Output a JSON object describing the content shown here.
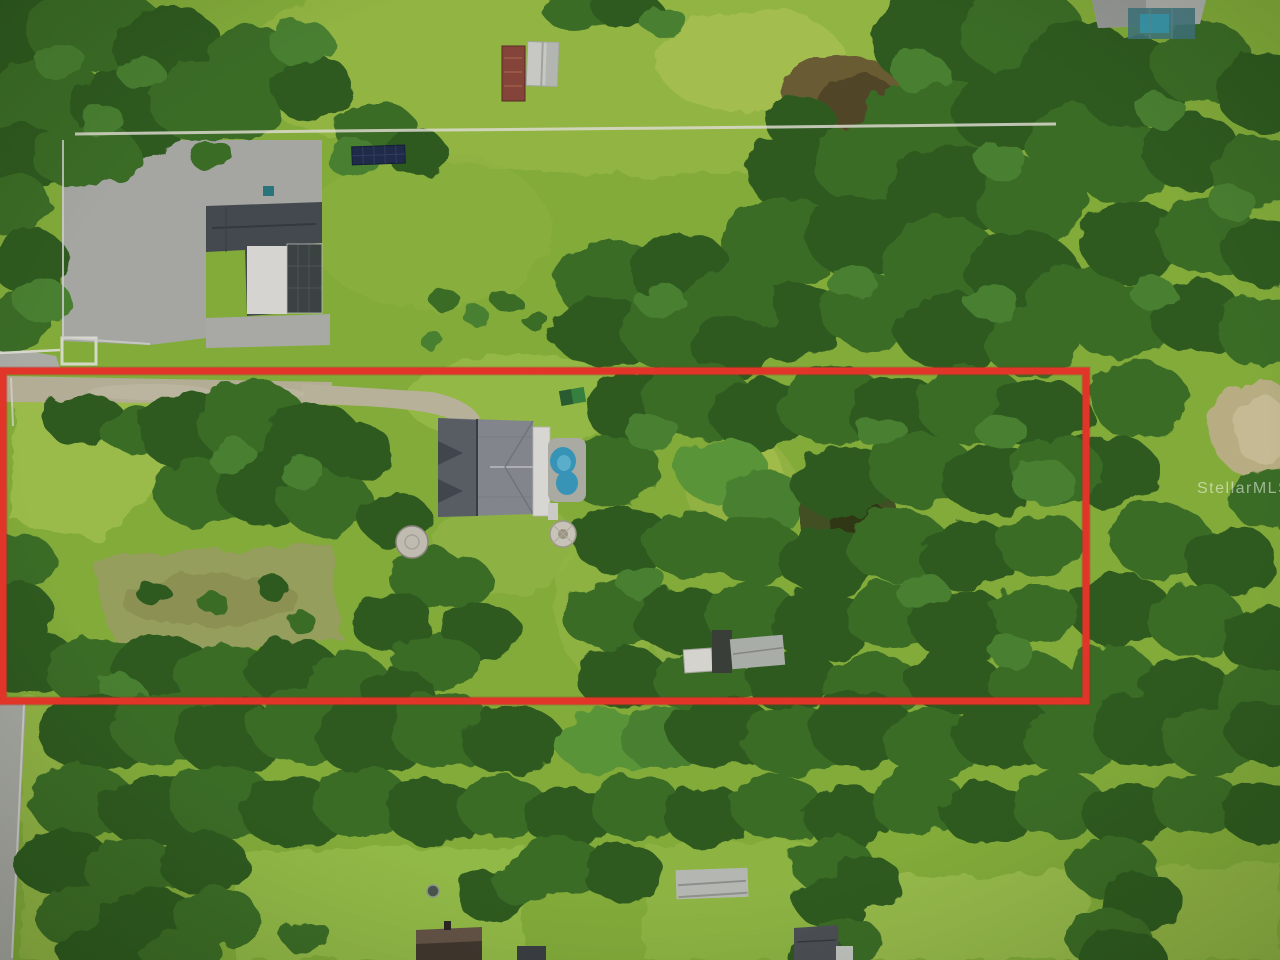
{
  "meta": {
    "type": "real-estate-aerial-photograph",
    "view": "top-down drone view of a rural wooded homesite",
    "width_px": 1280,
    "height_px": 960
  },
  "watermark": {
    "text": "StellarMLS",
    "color": "#ffffff",
    "opacity": 0.5
  },
  "boundary": {
    "label": "subject-parcel-outline",
    "color": "#e13529",
    "stroke_width": 7,
    "x": 3,
    "y": 371,
    "width": 1083,
    "height": 330
  },
  "palette": {
    "grass_base": "#8cb83f",
    "grass_bright": "#a8cb52",
    "grass_dry": "#a3a866",
    "tree_dark": "#24491a",
    "tree_mid": "#3f752b",
    "tree_light": "#4f8a34",
    "road_gray": "#b4b5b0",
    "dirt_tan": "#c5bda4",
    "marsh_brown": "#6f5e36",
    "sand": "#c9bb90",
    "pool_water": "#3da0c6",
    "roof_main": "#8d9198",
    "roof_neighbor": "#4a4f57",
    "barn_white": "#d7d9d4",
    "trailer_rust": "#8f4a3e",
    "solar_navy": "#232f4f"
  },
  "scene": {
    "description": "Aerial photo of a long narrow wooded parcel outlined in red containing a gray-roofed house, kidney-shaped pool, sheds and dense oak canopy, surrounded by neighboring homes, pastures, a barn and a road.",
    "subject_parcel": [
      "main house with gray shingle roof",
      "white lanai and paver pool deck",
      "kidney-shaped swimming pool",
      "green play set",
      "round patio / well cover",
      "storage sheds near south line",
      "dirt drive along north boundary",
      "dense oak canopy and open meadows"
    ],
    "surroundings": [
      "neighbor house with screened pool enclosure and paved court (northwest)",
      "white barn and rusted trailer (north)",
      "ground-mounted solar array",
      "white fence path running east-west",
      "marshy brown patch (northeast)",
      "two-lane road along southwest edge",
      "long barn and small houses (south)",
      "open pasture fields"
    ]
  }
}
